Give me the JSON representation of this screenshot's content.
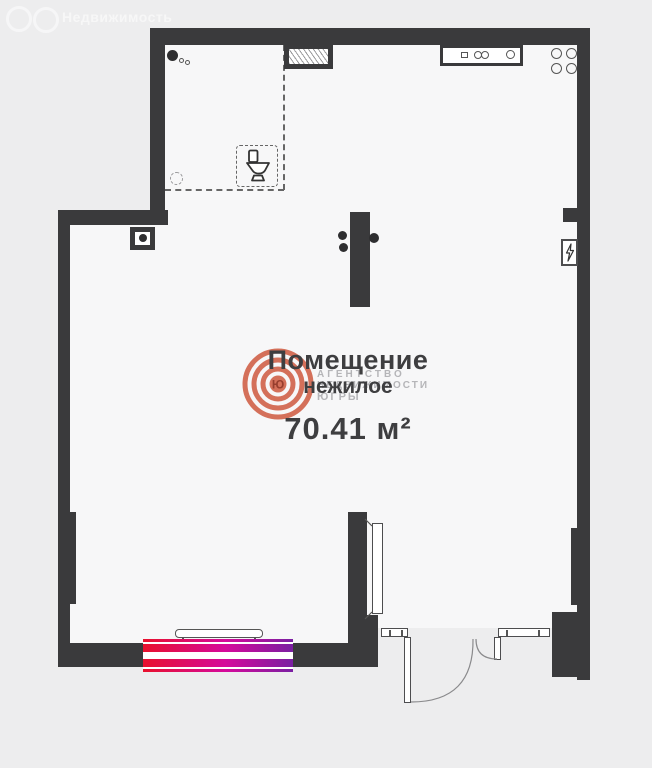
{
  "header_watermark": {
    "brand": "Недвижимость",
    "logo_letter": "Ю"
  },
  "room_label": {
    "title": "Помещение",
    "subtitle": "нежилое",
    "area": "70.41 м²"
  },
  "agency_watermark": {
    "logo_letter": "Ю",
    "lines": [
      "АГЕНТСТВО",
      "НЕДВИЖИМОСТИ",
      "ЮГРЫ"
    ]
  },
  "colors": {
    "background": "#ededee",
    "interior": "#f7f7f8",
    "wall": "#3a3a3c",
    "agency_logo": "#d2654d",
    "window_gradient_left": "#e8112d",
    "window_gradient_mid": "#d50a9b",
    "window_gradient_right": "#7a1fa2"
  }
}
